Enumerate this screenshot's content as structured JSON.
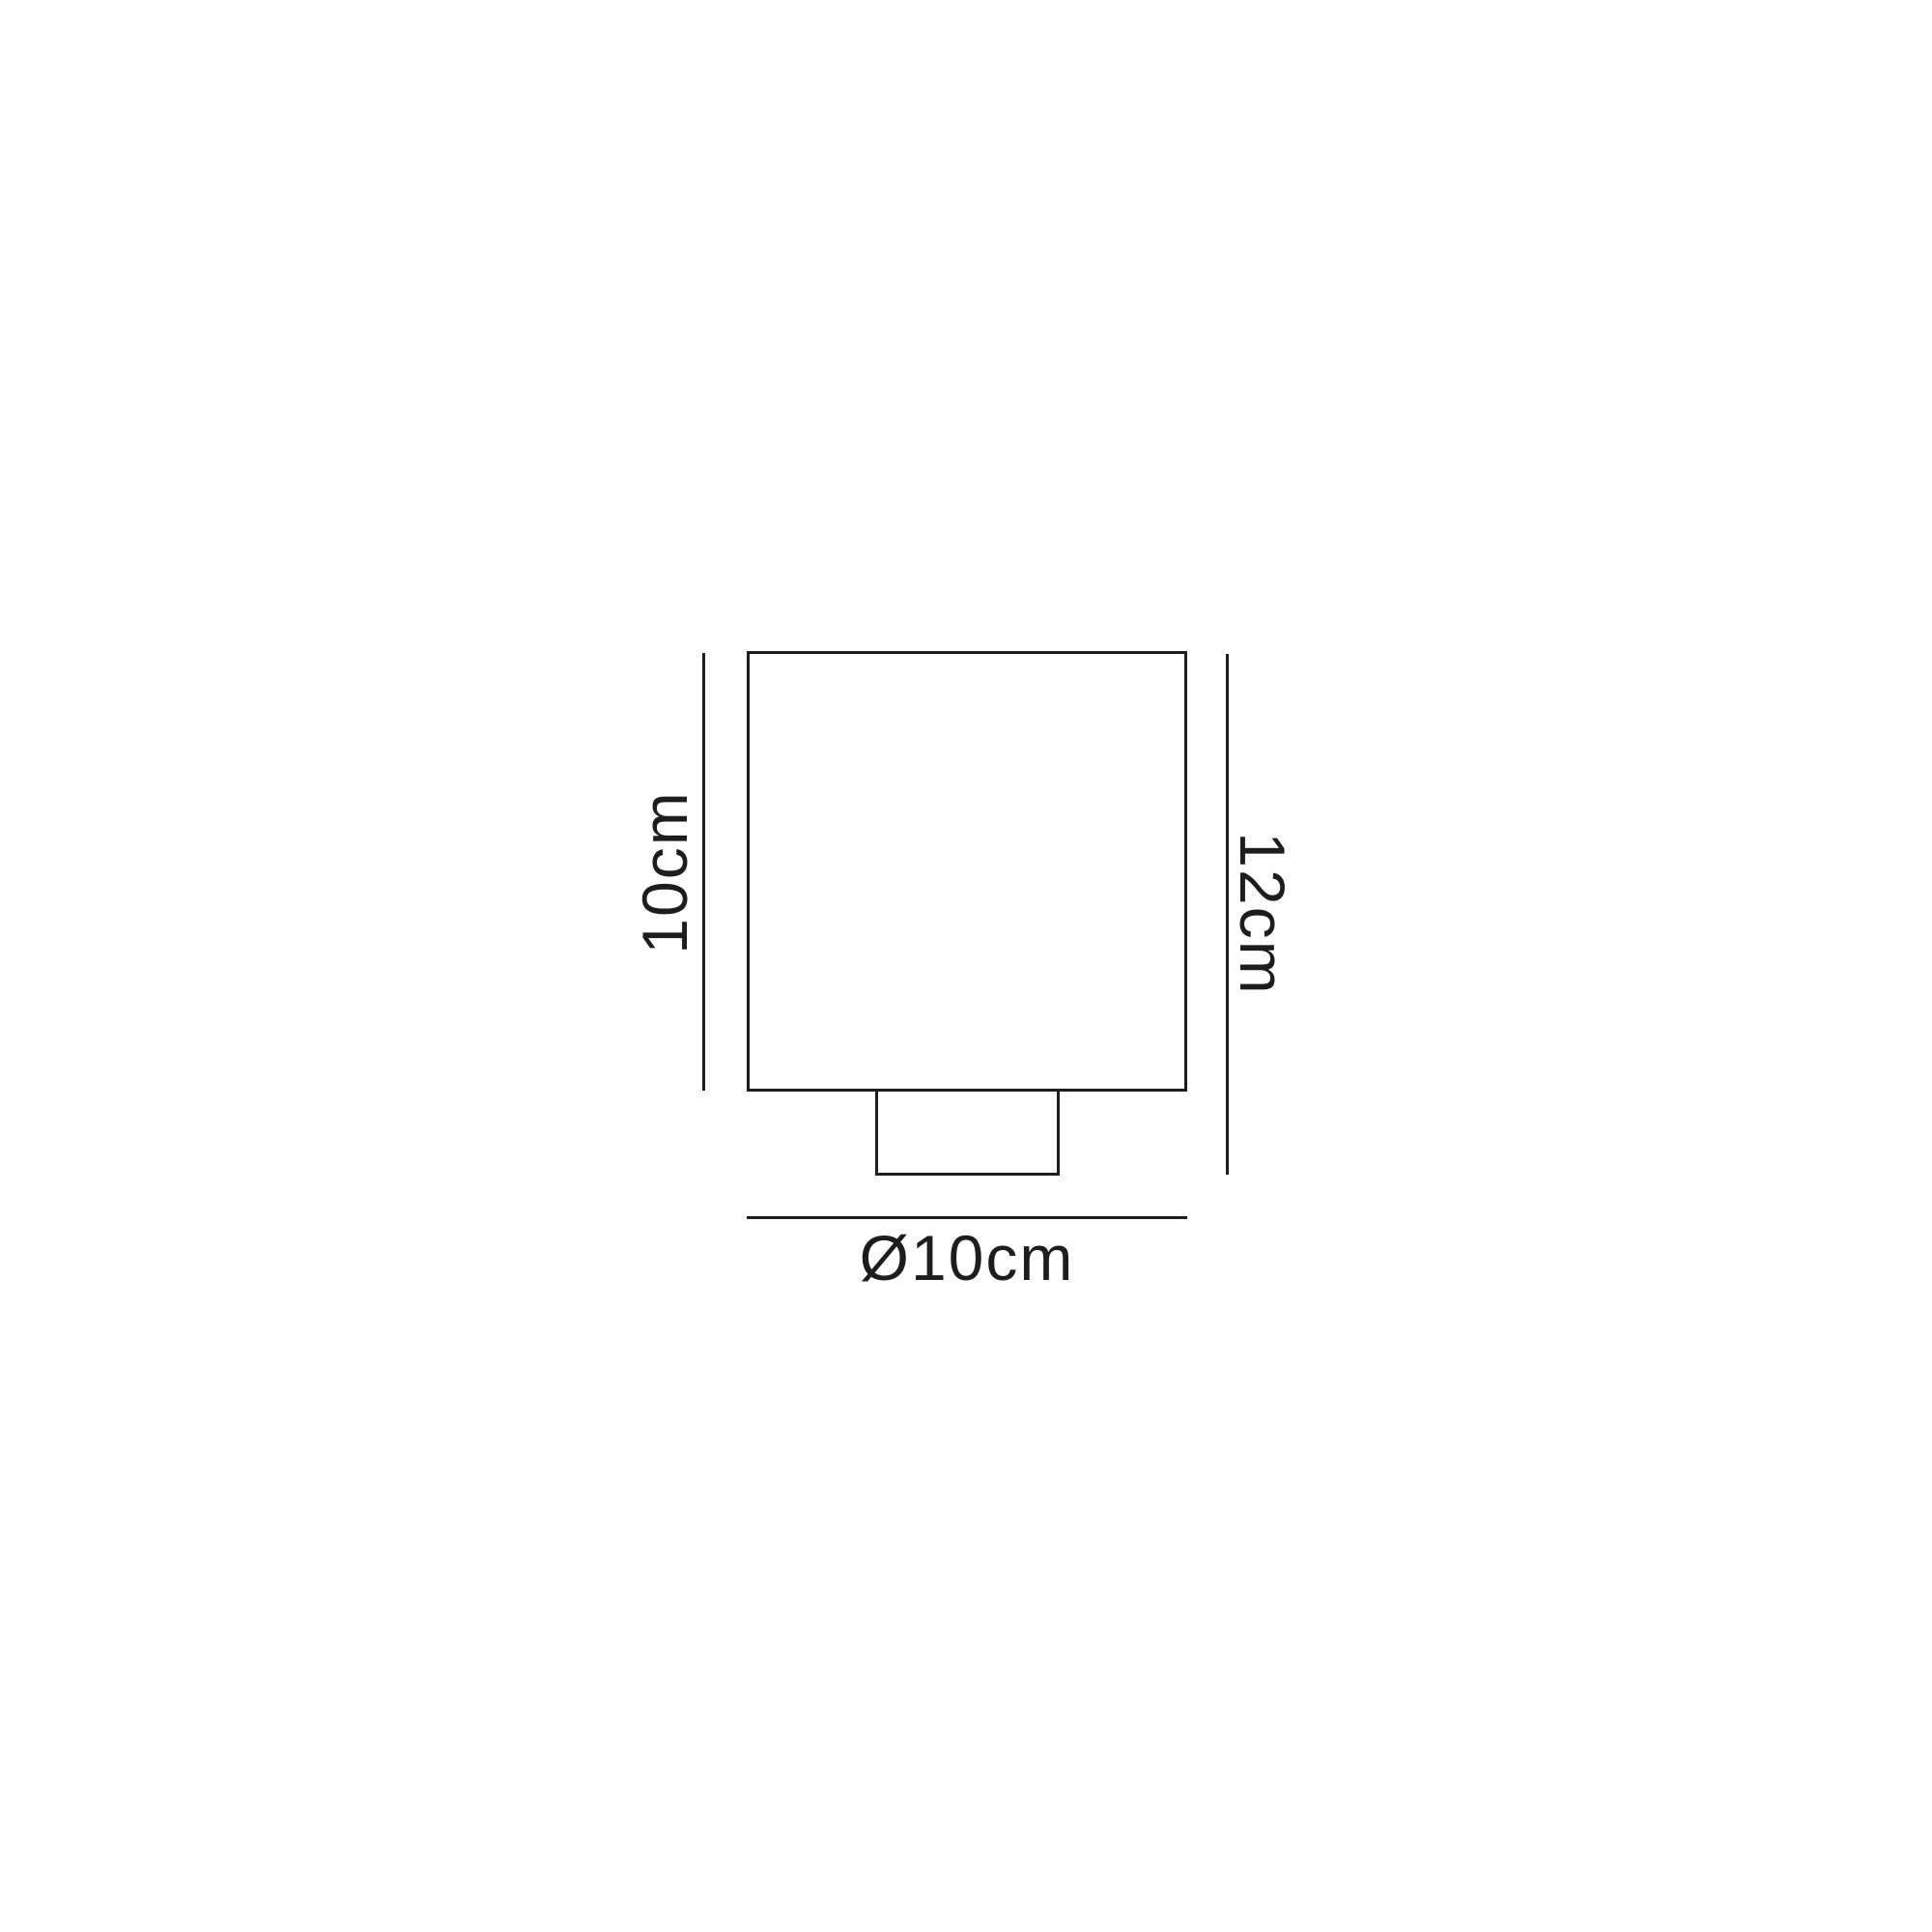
{
  "diagram": {
    "type": "product-dimension-drawing",
    "background_color": "#ffffff",
    "line_color": "#1d1d1b",
    "shapes": {
      "shade": "square-outline",
      "base": "small-rectangle-outline"
    },
    "left_dimension_label": "10cm",
    "right_dimension_label": "12cm",
    "bottom_dimension_label": "Ø10cm"
  }
}
